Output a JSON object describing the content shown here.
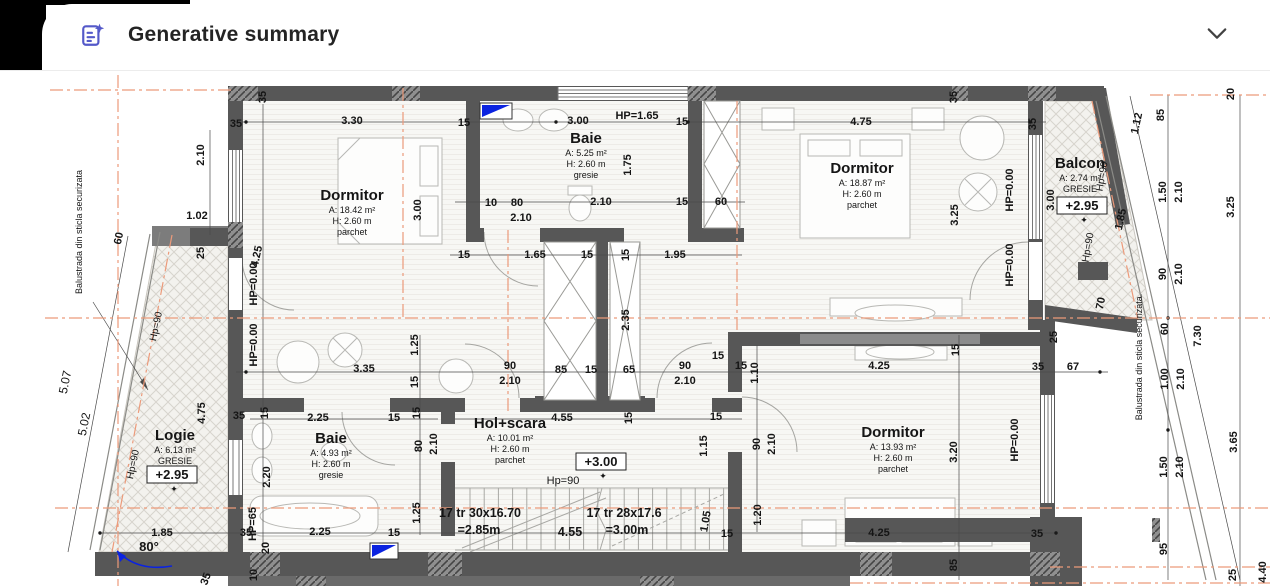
{
  "header": {
    "title": "Generative summary",
    "icon": "generative-summary-icon",
    "accent_color": "#5459c9",
    "chevron_icon": "chevron-down-icon"
  },
  "plan": {
    "colors": {
      "wall": "#575757",
      "axis": "#ec9a7a",
      "blue": "#0b23e0"
    },
    "rooms": [
      {
        "name": "Dormitor",
        "lines": [
          "A: 18.42 m²",
          "H: 2.60 m",
          "parchet"
        ],
        "cx": 352,
        "cy": 200
      },
      {
        "name": "Baie",
        "lines": [
          "A: 5.25 m²",
          "H: 2.60 m",
          "gresie"
        ],
        "cx": 586,
        "cy": 143
      },
      {
        "name": "Dormitor",
        "lines": [
          "A: 18.87 m²",
          "H: 2.60 m",
          "parchet"
        ],
        "cx": 862,
        "cy": 173
      },
      {
        "name": "Balcon",
        "lines": [
          "A: 2.74 m²",
          "GRESIE"
        ],
        "cx": 1080,
        "cy": 168
      },
      {
        "name": "Logie",
        "lines": [
          "A: 6.13 m²",
          "GRESIE"
        ],
        "cx": 175,
        "cy": 440
      },
      {
        "name": "Baie",
        "lines": [
          "A: 4.93 m²",
          "H: 2.60 m",
          "gresie"
        ],
        "cx": 331,
        "cy": 443
      },
      {
        "name": "Hol+scara",
        "lines": [
          "A: 10.01 m²",
          "H: 2.60 m",
          "parchet"
        ],
        "cx": 510,
        "cy": 428
      },
      {
        "name": "Dormitor",
        "lines": [
          "A: 13.93 m²",
          "H: 2.60 m",
          "parchet"
        ],
        "cx": 893,
        "cy": 437
      }
    ],
    "elevations": [
      {
        "label": "+2.95",
        "x": 1082,
        "y": 210
      },
      {
        "label": "+2.95",
        "x": 172,
        "y": 479
      },
      {
        "label": "+3.00",
        "x": 601,
        "y": 466
      }
    ],
    "stair_texts": [
      {
        "t": "17 tr 30x16.70",
        "x": 480,
        "y": 517
      },
      {
        "t": "=2.85m",
        "x": 479,
        "y": 534
      },
      {
        "t": "17 tr 28x17.6",
        "x": 624,
        "y": 517
      },
      {
        "t": "=3.00m",
        "x": 627,
        "y": 534
      },
      {
        "t": "4.55",
        "x": 570,
        "y": 536
      }
    ],
    "notes": [
      {
        "t": "Balustrada din sticla securizata",
        "x": 82,
        "y": 232,
        "r": -90,
        "s": 9
      },
      {
        "t": "Balustrada din sticla securizata.",
        "x": 1142,
        "y": 357,
        "r": -90,
        "s": 9
      },
      {
        "t": "Hp=90",
        "x": 563,
        "y": 484,
        "r": 0,
        "s": 11
      },
      {
        "t": "Hp=90",
        "x": 159,
        "y": 327,
        "r": -78,
        "s": 10
      },
      {
        "t": "Hp=90",
        "x": 136,
        "y": 465,
        "r": -78,
        "s": 10
      },
      {
        "t": "Hp=90",
        "x": 1105,
        "y": 177,
        "r": -80,
        "s": 10
      },
      {
        "t": "Hp=90",
        "x": 1091,
        "y": 248,
        "r": -80,
        "s": 10
      },
      {
        "t": "5.07",
        "x": 69,
        "y": 383,
        "r": -78,
        "s": 12
      },
      {
        "t": "5.02",
        "x": 88,
        "y": 425,
        "r": -78,
        "s": 12
      }
    ],
    "angle": {
      "t": "80°",
      "x": 149,
      "y": 551
    },
    "dims": [
      [
        "35",
        236,
        127,
        0
      ],
      [
        "35",
        266,
        97,
        -90
      ],
      [
        "3.30",
        352,
        124,
        0
      ],
      [
        "15",
        464,
        126,
        0
      ],
      [
        "3.00",
        578,
        124,
        0
      ],
      [
        "HP=1.65",
        637,
        119,
        0
      ],
      [
        "15",
        682,
        125,
        0
      ],
      [
        "4.75",
        861,
        125,
        0
      ],
      [
        "35",
        957,
        97,
        -90
      ],
      [
        "35",
        1036,
        124,
        -90
      ],
      [
        "1.12",
        1140,
        124,
        -78
      ],
      [
        "85",
        1164,
        115,
        -90
      ],
      [
        "20",
        1234,
        94,
        -90
      ],
      [
        "2.10",
        204,
        155,
        -90
      ],
      [
        "3.00",
        421,
        210,
        -90
      ],
      [
        "1.75",
        631,
        165,
        -90
      ],
      [
        "10",
        491,
        206,
        0
      ],
      [
        "80",
        517,
        206,
        0
      ],
      [
        "2.10",
        521,
        221,
        0
      ],
      [
        "2.10",
        601,
        205,
        0
      ],
      [
        "15",
        682,
        205,
        0
      ],
      [
        "60",
        721,
        205,
        0
      ],
      [
        "3.25",
        958,
        215,
        -90
      ],
      [
        "HP=0.00",
        1013,
        190,
        -90
      ],
      [
        "HP=0.00",
        1013,
        265,
        -90
      ],
      [
        "3.00",
        1054,
        200,
        -90
      ],
      [
        "1.50",
        1166,
        192,
        -90
      ],
      [
        "2.10",
        1182,
        192,
        -90
      ],
      [
        "3.25",
        1234,
        207,
        -90
      ],
      [
        "1.85",
        1124,
        220,
        -78
      ],
      [
        "1.02",
        197,
        219,
        0
      ],
      [
        "25",
        204,
        253,
        -90
      ],
      [
        "4.25",
        260,
        257,
        -78
      ],
      [
        "HP=0.00",
        257,
        284,
        -90
      ],
      [
        "HP=0.00",
        257,
        345,
        -90
      ],
      [
        "60",
        122,
        239,
        -78
      ],
      [
        "15",
        464,
        258,
        0
      ],
      [
        "1.65",
        535,
        258,
        0
      ],
      [
        "15",
        587,
        258,
        0
      ],
      [
        "15",
        629,
        255,
        -90
      ],
      [
        "1.95",
        675,
        258,
        0
      ],
      [
        "2.35",
        629,
        320,
        -90
      ],
      [
        "90",
        1166,
        274,
        -90
      ],
      [
        "2.10",
        1182,
        274,
        -90
      ],
      [
        "70",
        1104,
        304,
        -78
      ],
      [
        "25",
        1057,
        337,
        -90
      ],
      [
        "60",
        1168,
        329,
        -90
      ],
      [
        "7.30",
        1201,
        336,
        -90
      ],
      [
        "35",
        1038,
        370,
        0
      ],
      [
        "67",
        1073,
        370,
        0
      ],
      [
        "1.00",
        1168,
        379,
        -90
      ],
      [
        "2.10",
        1184,
        379,
        -90
      ],
      [
        "3.65",
        1237,
        442,
        -90
      ],
      [
        "1.50",
        1167,
        467,
        -90
      ],
      [
        "2.10",
        1183,
        467,
        -90
      ],
      [
        "95",
        1167,
        549,
        -90
      ],
      [
        "25",
        1236,
        575,
        -90
      ],
      [
        "4.40",
        1266,
        572,
        -90
      ],
      [
        "3.35",
        364,
        372,
        0
      ],
      [
        "1.25",
        418,
        345,
        -90
      ],
      [
        "15",
        418,
        382,
        -90
      ],
      [
        "90",
        510,
        369,
        0
      ],
      [
        "2.10",
        510,
        384,
        0
      ],
      [
        "85",
        561,
        373,
        0
      ],
      [
        "15",
        591,
        373,
        0
      ],
      [
        "65",
        629,
        373,
        0
      ],
      [
        "90",
        685,
        369,
        0
      ],
      [
        "2.10",
        685,
        384,
        0
      ],
      [
        "15",
        718,
        359,
        0
      ],
      [
        "15",
        741,
        369,
        0
      ],
      [
        "1.10",
        758,
        373,
        -90
      ],
      [
        "4.25",
        879,
        369,
        0
      ],
      [
        "15",
        959,
        350,
        -90
      ],
      [
        "4.75",
        205,
        413,
        -90
      ],
      [
        "35",
        239,
        419,
        0
      ],
      [
        "15",
        268,
        413,
        -90
      ],
      [
        "2.25",
        318,
        421,
        0
      ],
      [
        "15",
        394,
        421,
        0
      ],
      [
        "15",
        420,
        413,
        -90
      ],
      [
        "80",
        422,
        446,
        -90
      ],
      [
        "2.10",
        437,
        444,
        -90
      ],
      [
        "4.55",
        562,
        421,
        0
      ],
      [
        "15",
        632,
        418,
        -90
      ],
      [
        "15",
        716,
        420,
        0
      ],
      [
        "1.15",
        707,
        446,
        -90
      ],
      [
        "90",
        760,
        444,
        -90
      ],
      [
        "2.10",
        775,
        444,
        -90
      ],
      [
        "2.20",
        270,
        477,
        -90
      ],
      [
        "1.25",
        420,
        513,
        -90
      ],
      [
        "1.05",
        709,
        522,
        -80
      ],
      [
        "1.20",
        761,
        515,
        -90
      ],
      [
        "3.20",
        957,
        452,
        -90
      ],
      [
        "HP=0.00",
        1018,
        440,
        -90
      ],
      [
        "HP=65",
        256,
        524,
        -90
      ],
      [
        "20",
        269,
        548,
        -90
      ],
      [
        "1.85",
        162,
        536,
        0
      ],
      [
        "35",
        246,
        536,
        0
      ],
      [
        "2.25",
        320,
        535,
        0
      ],
      [
        "15",
        394,
        536,
        0
      ],
      [
        "15",
        727,
        537,
        0
      ],
      [
        "4.25",
        879,
        536,
        0
      ],
      [
        "35",
        1037,
        537,
        0
      ],
      [
        "85",
        957,
        565,
        -90
      ],
      [
        "35",
        209,
        580,
        -70
      ],
      [
        "10",
        257,
        575,
        -90
      ]
    ]
  }
}
